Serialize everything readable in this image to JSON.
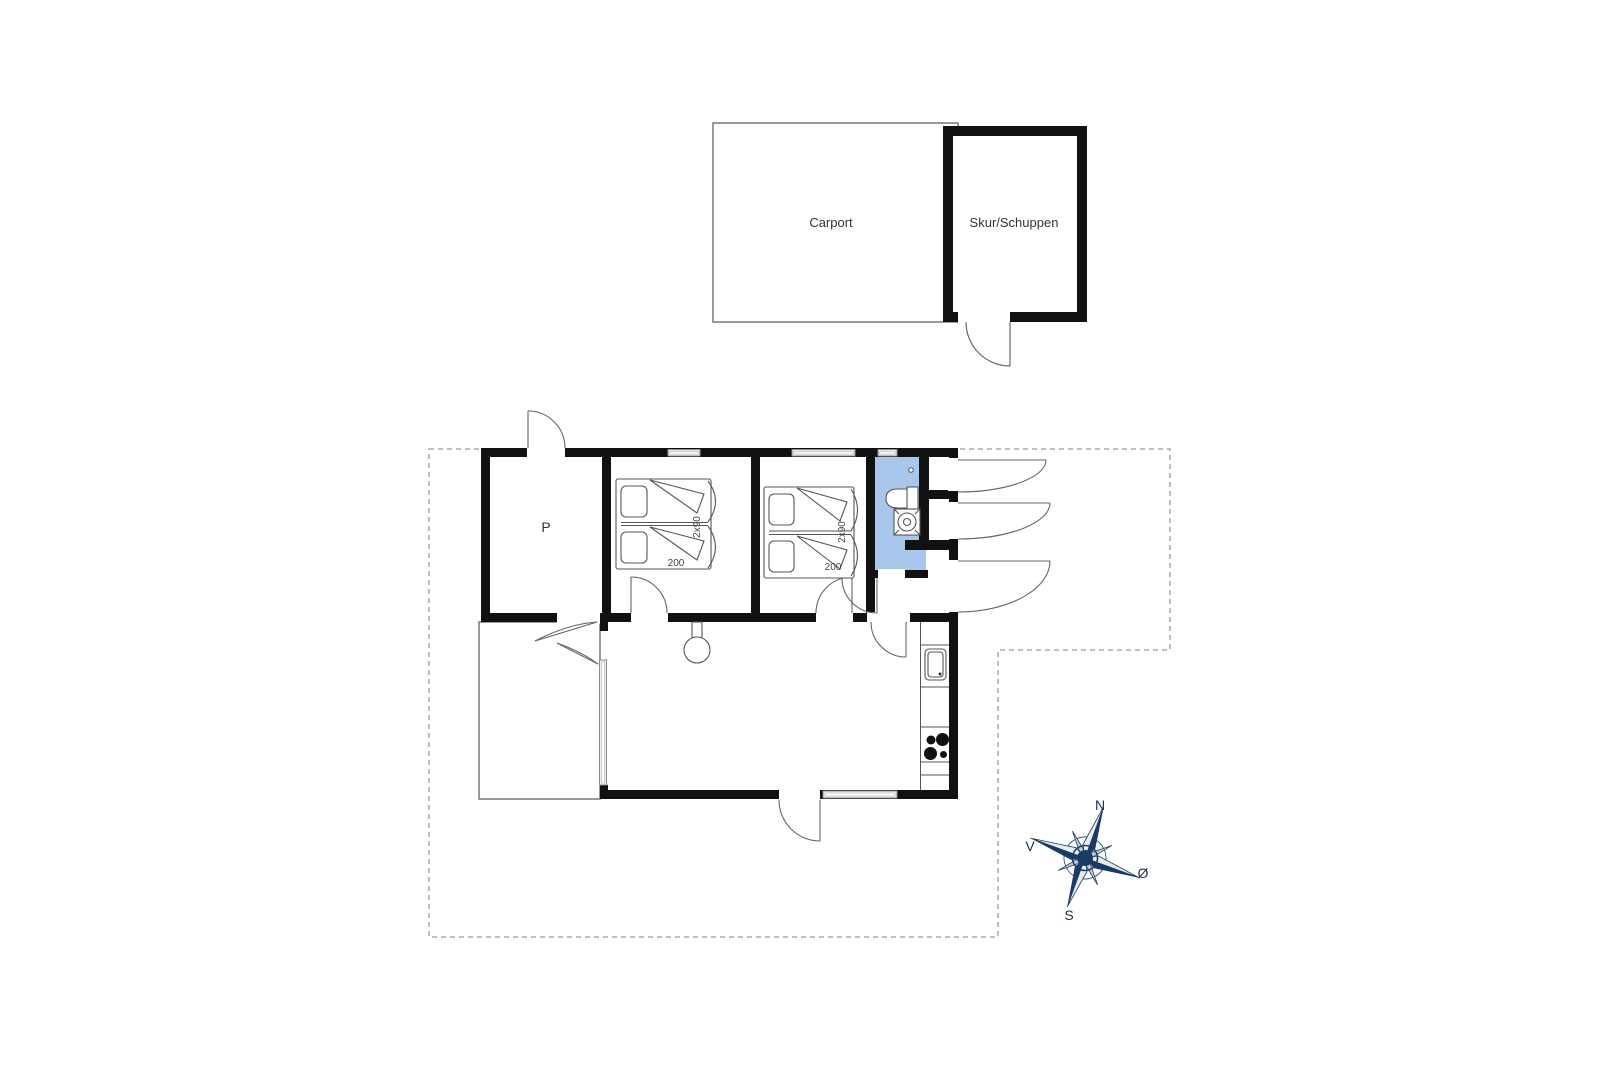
{
  "floorplan": {
    "outbuildings": {
      "carport_label": "Carport",
      "shed_label": "Skur/Schuppen"
    },
    "rooms": {
      "storage_label": "P"
    },
    "beds": {
      "bed1": {
        "width_label": "2x90",
        "length_label": "200"
      },
      "bed2": {
        "width_label": "2x90",
        "length_label": "200"
      }
    },
    "compass": {
      "north": "N",
      "east": "Ø",
      "south": "S",
      "west": "V"
    },
    "colors": {
      "wall": "#111111",
      "bathroom_fill": "#a9c7eb",
      "compass_navy": "#1c3a66",
      "compass_silver": "#c3cbd4",
      "boundary_dash": "#999999"
    }
  }
}
